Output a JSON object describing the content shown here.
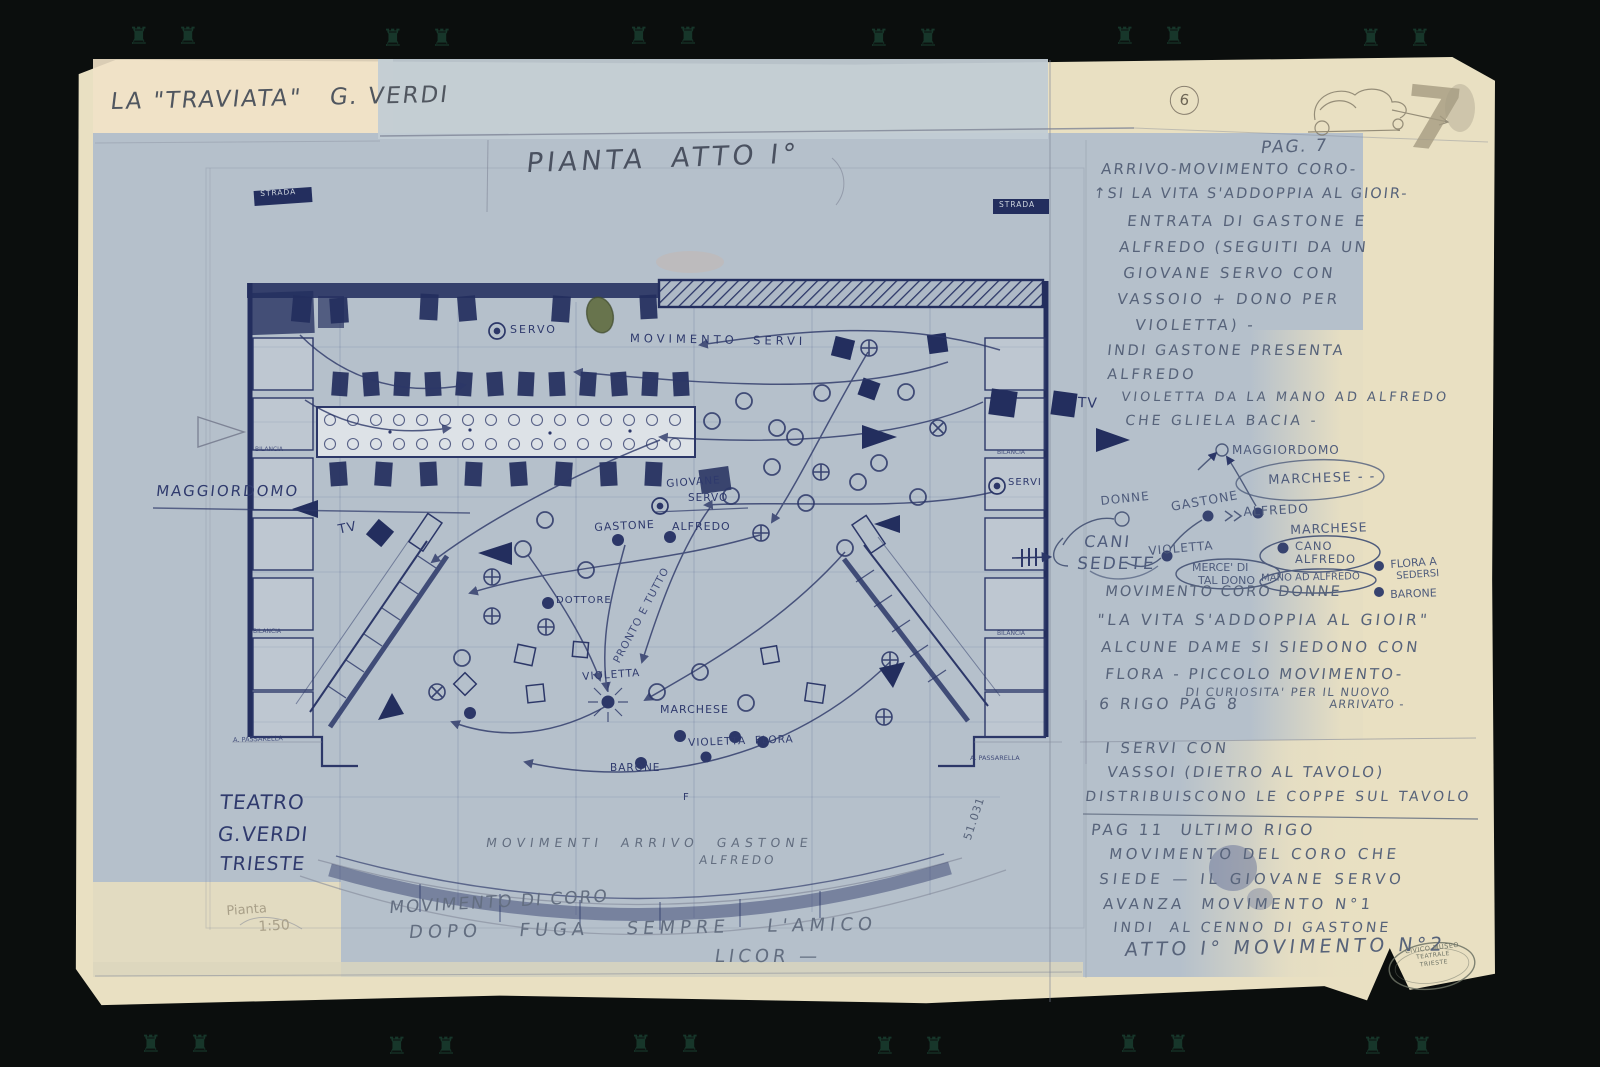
{
  "document": {
    "work_title": "LA \"TRAVIATA\"   G. VERDI",
    "plan_title": "PIANTA  ATTO I°",
    "sheet_number_circled": "6",
    "corner_number": "7",
    "page_ref": "PAG. 7"
  },
  "notes_arrival": {
    "l1": "ARRIVO-MOVIMENTO CORO-",
    "l2": "↑SI LA VITA S'ADDOPPIA AL GIOIR-",
    "l3": "ENTRATA DI GASTONE E",
    "l4": "ALFREDO (SEGUITI DA UN",
    "l5": "GIOVANE SERVO CON",
    "l6": "VASSOIO + DONO PER",
    "l7": "VIOLETTA) -"
  },
  "notes_presentation": {
    "l1": "INDI GASTONE PRESENTA",
    "l2": "ALFREDO",
    "l3": "VIOLETTA DA LA MANO AD ALFREDO",
    "l4": "CHE GLIELA BACIA -"
  },
  "sketch": {
    "maggiordomo": "MAGGIORDOMO",
    "marchese_top": "MARCHESE - -",
    "donne": "DONNE",
    "gastone": "GASTONE",
    "alfredo": "ALFREDO",
    "marchese": "MARCHESE",
    "cani": "CANI",
    "sedete": "SEDETE",
    "violetta": "VIOLETTA",
    "cano": "CANO",
    "cano2": "ALFREDO",
    "merce1": "MERCE' DI",
    "merce2": "TAL DONO",
    "mano": "MANO AD ALFREDO",
    "flora1": "FLORA A",
    "flora2": "SEDERSI",
    "barone": "BARONE"
  },
  "notes_choir": {
    "l1": "MOVIMENTO CORO DONNE",
    "l2": "\"LA VITA S'ADDOPPIA AL GIOIR\"",
    "l3": "ALCUNE DAME SI SIEDONO CON",
    "l4": "FLORA - PICCOLO MOVIMENTO-",
    "l5": "DI CURIOSITA' PER IL NUOVO",
    "l6": "ARRIVATO -",
    "l7": "6 RIGO PAG 8"
  },
  "notes_servants": {
    "l1": "I SERVI CON",
    "l2": "VASSOI (DIETRO AL TAVOLO)",
    "l3": "DISTRIBUISCONO LE COPPE SUL TAVOLO"
  },
  "notes_pag11": {
    "l1": "PAG 11  ULTIMO RIGO",
    "l2": "MOVIMENTO DEL CORO CHE",
    "l3": "SIEDE — IL GIOVANE SERVO",
    "l4": "AVANZA  MOVIMENTO N°1",
    "l5": "INDI  AL CENNO DI GASTONE",
    "l6": "ATTO I° MOVIMENTO N°2"
  },
  "plan": {
    "strada_left": "STRADA",
    "strada_right": "STRADA",
    "servo": "SERVO",
    "movimento_servi": "MOVIMENTO  SERVI",
    "maggiordomo": "MAGGIORDOMO",
    "tv_left": "TV",
    "tv_right": "TV",
    "giovane": "GIOVANE",
    "giovane2": "SERVO",
    "gastone": "GASTONE",
    "alfredo": "ALFREDO",
    "servi": "SERVI",
    "dottore": "DOTTORE",
    "pronto": "PRONTO E TUTTO",
    "violetta": "VIOLETTA",
    "marchese": "MARCHESE",
    "violetta_flora": "VIOLETTA  FLORA",
    "barone": "BARONE",
    "f_mark": "F",
    "bilancia_left_1": "BILANCIA",
    "bilancia_left_2": "BILANCIA",
    "passarella_left": "A. PASSARELLA",
    "bilancia_right_1": "BILANCIA",
    "bilancia_right_2": "BILANCIA",
    "passarella_right": "A. PASSARELLA",
    "ref_number": "51.031"
  },
  "bottom": {
    "movimenti_arrivo": "MOVIMENTI  ARRIVO  GASTONE",
    "alfredo": "ALFREDO",
    "movimento_coro": "MOVIMENTO DI CORO",
    "dopo_fuga": "DOPO  FUGA  SEMPRE  L'AMICO",
    "licor": "LICOR —"
  },
  "theater": {
    "l1": "TEATRO",
    "l2": "G.VERDI",
    "l3": "TRIESTE",
    "note": "Pianta",
    "scale": "1:50"
  },
  "stamp": {
    "l1": "CIVICO MUSEO",
    "l2": "TEATRALE",
    "l3": "TRIESTE"
  },
  "ornaments": {
    "pair": "♜ ♜"
  },
  "colors": {
    "ink_blue": "#2f3a6d",
    "pencil_blue": "#57637a",
    "graphite": "#50565f",
    "paper_blue": "#b5c0cb",
    "paper_cream": "#e9e0c2",
    "background": "#0b0e0d",
    "olive_stain": "#5f6b3f"
  }
}
